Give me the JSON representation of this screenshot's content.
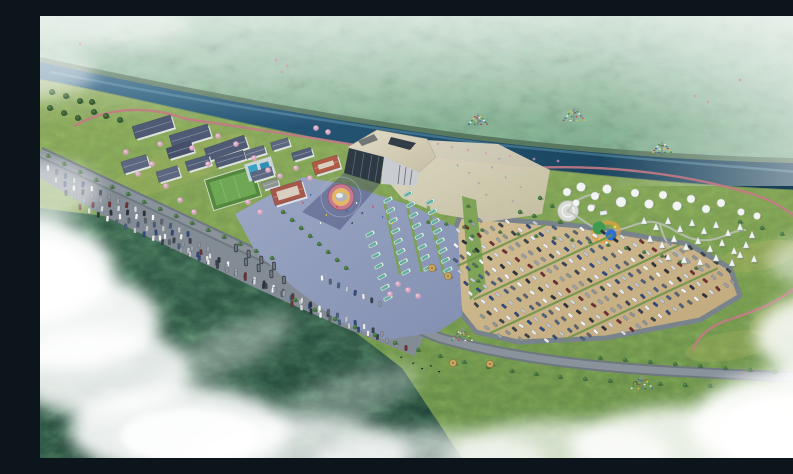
{
  "meta": {
    "title": "Aerial rendering of riverside visitor-center resort",
    "description": "Bird's-eye architectural rendering: forested mountain across a river, visitor center with faceted roof on a blue plaza, residential blocks, bus and dirt car parking lots full of vehicles, glamping dome and teepee camp, red walking trail, clouds and mist at the edges.",
    "width": 793,
    "height": 442
  },
  "palette": {
    "mountain_green": "#74a183",
    "haze_white": "#ffffff",
    "river_blue": "#1f4a66",
    "river_light": "#5e93ad",
    "grass_green": "#7a9c52",
    "grass_yellow": "#b7b565",
    "forest_dark": "#2c5644",
    "plaza_blue": "#96a2bf",
    "dirt_tan": "#c9b289",
    "gravel_tan": "#d8cfb4",
    "road_grey": "#79838b",
    "roof_beige": "#d5cfba",
    "glass_dark": "#2e3944",
    "roof_slate": "#4f5a74",
    "roof_red": "#a8584a",
    "trail_red": "#c2607a",
    "bus_teal": "#5fae9e",
    "field_green": "#5f9447",
    "pool_blue": "#39a3c6",
    "blossom_pink": "#d9a3c0",
    "tent_white": "#f2f4f4"
  },
  "scene": {
    "car_colors": [
      "#f2f4f6",
      "#e8eaec",
      "#d7dadd",
      "#c2c7cc",
      "#9aa1a8",
      "#5b646e",
      "#3a424c",
      "#2c333c",
      "#31497e",
      "#6e2f35",
      "#49607f",
      "#8d939a"
    ],
    "flag_colors": [
      "#c23b3b",
      "#e8c63f",
      "#2f8a4c",
      "#f2f2f2",
      "#2f5fae"
    ],
    "main_lot": {
      "polygon": [
        [
          420,
          200
        ],
        [
          540,
          210
        ],
        [
          648,
          228
        ],
        [
          690,
          252
        ],
        [
          700,
          280
        ],
        [
          660,
          304
        ],
        [
          566,
          322
        ],
        [
          478,
          326
        ],
        [
          436,
          316
        ],
        [
          420,
          296
        ],
        [
          414,
          250
        ],
        [
          414,
          216
        ]
      ],
      "origin": [
        404,
        222
      ],
      "u": [
        7.3,
        -3.4
      ],
      "v": [
        5.4,
        11.2
      ],
      "ni": 46,
      "nj": 14,
      "hedge_rows": [
        2,
        5,
        8,
        11
      ],
      "car_angle": 41
    },
    "car_rows": [
      {
        "s": [
          8,
          152
        ],
        "e": [
          148,
          218
        ],
        "n": 17
      },
      {
        "s": [
          16,
          164
        ],
        "e": [
          168,
          233
        ],
        "n": 18
      },
      {
        "s": [
          26,
          177
        ],
        "e": [
          188,
          248
        ],
        "n": 19
      },
      {
        "s": [
          40,
          191
        ],
        "e": [
          214,
          265
        ],
        "n": 20
      },
      {
        "s": [
          120,
          222
        ],
        "e": [
          262,
          284
        ],
        "n": 16
      },
      {
        "s": [
          150,
          238
        ],
        "e": [
          288,
          298
        ],
        "n": 16
      },
      {
        "s": [
          226,
          270
        ],
        "e": [
          342,
          318
        ],
        "n": 14
      },
      {
        "s": [
          252,
          288
        ],
        "e": [
          366,
          332
        ],
        "n": 13
      },
      {
        "s": [
          282,
          262
        ],
        "e": [
          340,
          288
        ],
        "n": 8
      }
    ],
    "bus_rows": [
      {
        "s": [
          348,
          184
        ],
        "e": [
          366,
          256
        ],
        "n": 8
      },
      {
        "s": [
          368,
          178
        ],
        "e": [
          388,
          252
        ],
        "n": 8
      },
      {
        "s": [
          390,
          186
        ],
        "e": [
          408,
          254
        ],
        "n": 8
      },
      {
        "s": [
          330,
          218
        ],
        "e": [
          348,
          282
        ],
        "n": 7
      }
    ],
    "shuttle_rows": [
      {
        "s": [
          196,
          232
        ],
        "e": [
          234,
          250
        ],
        "n": 4
      },
      {
        "s": [
          206,
          246
        ],
        "e": [
          244,
          264
        ],
        "n": 4
      }
    ],
    "buildings": [
      {
        "c": [
          113,
          111
        ],
        "w": 40,
        "h": 13,
        "r": -17,
        "roof": "#4f5a74"
      },
      {
        "c": [
          150,
          120
        ],
        "w": 40,
        "h": 13,
        "r": -17,
        "roof": "#4f5a74"
      },
      {
        "c": [
          186,
          132
        ],
        "w": 42,
        "h": 13,
        "r": -19,
        "roof": "#4f5a74"
      },
      {
        "c": [
          140,
          134
        ],
        "w": 26,
        "h": 11,
        "r": -17,
        "roof": "#46506a"
      },
      {
        "c": [
          95,
          148
        ],
        "w": 26,
        "h": 12,
        "r": -17,
        "roof": "#5d6880"
      },
      {
        "c": [
          128,
          158
        ],
        "w": 22,
        "h": 11,
        "r": -17,
        "roof": "#5d6880"
      },
      {
        "c": [
          158,
          147
        ],
        "w": 24,
        "h": 10,
        "r": -17,
        "roof": "#525e78"
      },
      {
        "c": [
          190,
          143
        ],
        "w": 30,
        "h": 9,
        "r": -17,
        "roof": "#4f5a74"
      },
      {
        "c": [
          215,
          136
        ],
        "w": 20,
        "h": 8,
        "r": -17,
        "roof": "#5d6880"
      },
      {
        "c": [
          240,
          128
        ],
        "w": 18,
        "h": 8,
        "r": -17,
        "roof": "#5d6880"
      },
      {
        "c": [
          262,
          138
        ],
        "w": 20,
        "h": 8,
        "r": -17,
        "roof": "#525e78"
      },
      {
        "c": [
          222,
          158
        ],
        "w": 22,
        "h": 9,
        "r": -17,
        "roof": "#5d6880"
      },
      {
        "c": [
          230,
          168
        ],
        "w": 16,
        "h": 7,
        "r": -17,
        "roof": "#8d968f"
      },
      {
        "c": [
          286,
          149
        ],
        "w": 26,
        "h": 13,
        "r": -17,
        "roof": "#b05a44",
        "court": true
      },
      {
        "c": [
          248,
          177
        ],
        "w": 32,
        "h": 17,
        "r": -17,
        "roof": "#a8584a",
        "court": true
      }
    ],
    "trees": [
      [
        255,
        284
      ],
      [
        275,
        294
      ],
      [
        295,
        303
      ],
      [
        315,
        311
      ],
      [
        335,
        319
      ],
      [
        355,
        327
      ],
      [
        378,
        334
      ],
      [
        400,
        340
      ],
      [
        424,
        346
      ],
      [
        448,
        351
      ],
      [
        472,
        355
      ],
      [
        496,
        358
      ],
      [
        520,
        361
      ],
      [
        545,
        363
      ],
      [
        570,
        365
      ],
      [
        595,
        367
      ],
      [
        620,
        368
      ],
      [
        645,
        369
      ],
      [
        670,
        370
      ],
      [
        560,
        342
      ],
      [
        585,
        344
      ],
      [
        610,
        346
      ],
      [
        635,
        348
      ],
      [
        660,
        350
      ],
      [
        685,
        352
      ],
      [
        710,
        354
      ],
      [
        735,
        356
      ],
      [
        760,
        358
      ],
      [
        243,
        196
      ],
      [
        252,
        204
      ],
      [
        261,
        212
      ],
      [
        270,
        220
      ],
      [
        279,
        228
      ],
      [
        288,
        236
      ],
      [
        297,
        244
      ],
      [
        306,
        252
      ],
      [
        8,
        140
      ],
      [
        24,
        148
      ],
      [
        40,
        156
      ],
      [
        56,
        164
      ],
      [
        72,
        171
      ],
      [
        88,
        178
      ],
      [
        104,
        186
      ],
      [
        120,
        193
      ],
      [
        136,
        200
      ],
      [
        152,
        207
      ],
      [
        168,
        214
      ],
      [
        184,
        221
      ],
      [
        200,
        228
      ],
      [
        216,
        235
      ],
      [
        232,
        242
      ],
      [
        428,
        190,
        1.8
      ],
      [
        430,
        205,
        1.8
      ],
      [
        432,
        220,
        1.8
      ],
      [
        434,
        235,
        1.8
      ],
      [
        436,
        250,
        1.8
      ],
      [
        438,
        265,
        1.8
      ],
      [
        388,
        206,
        1.8
      ],
      [
        406,
        208,
        1.8
      ],
      [
        424,
        211,
        1.8
      ],
      [
        442,
        214,
        1.8
      ],
      [
        460,
        216,
        1.8
      ],
      [
        478,
        218,
        1.8
      ],
      [
        496,
        220,
        1.8
      ],
      [
        514,
        222,
        1.8
      ],
      [
        532,
        224,
        1.8
      ],
      [
        550,
        226,
        1.8
      ],
      [
        568,
        229,
        1.8
      ],
      [
        586,
        232,
        1.8
      ],
      [
        604,
        236,
        1.8
      ],
      [
        622,
        240,
        1.8
      ],
      [
        640,
        246,
        1.8
      ],
      [
        656,
        252,
        1.8
      ],
      [
        500,
        182
      ],
      [
        512,
        190
      ],
      [
        494,
        200
      ],
      [
        520,
        206
      ],
      [
        480,
        196
      ],
      [
        700,
        206
      ],
      [
        722,
        212
      ],
      [
        742,
        218
      ]
    ],
    "bushes": [
      [
        12,
        76
      ],
      [
        26,
        80
      ],
      [
        40,
        85
      ],
      [
        10,
        92
      ],
      [
        24,
        97
      ],
      [
        38,
        102
      ],
      [
        54,
        96
      ],
      [
        66,
        100
      ],
      [
        80,
        104
      ],
      [
        52,
        86
      ]
    ],
    "blossoms": [
      [
        86,
        136
      ],
      [
        98,
        158
      ],
      [
        112,
        148
      ],
      [
        126,
        170
      ],
      [
        140,
        184
      ],
      [
        154,
        196
      ],
      [
        168,
        148
      ],
      [
        178,
        120
      ],
      [
        196,
        128
      ],
      [
        214,
        142
      ],
      [
        228,
        154
      ],
      [
        120,
        128
      ],
      [
        152,
        132
      ],
      [
        256,
        152
      ],
      [
        270,
        162
      ],
      [
        208,
        186
      ],
      [
        220,
        196
      ],
      [
        240,
        160
      ],
      [
        358,
        268
      ],
      [
        368,
        274
      ],
      [
        378,
        280
      ],
      [
        350,
        278
      ],
      [
        276,
        112
      ],
      [
        288,
        116
      ]
    ],
    "bank_pink": [
      [
        398,
        128
      ],
      [
        412,
        131
      ],
      [
        428,
        134
      ],
      [
        446,
        137
      ],
      [
        470,
        140
      ],
      [
        494,
        143
      ],
      [
        518,
        145
      ],
      [
        236,
        44
      ],
      [
        247,
        50
      ],
      [
        242,
        56
      ],
      [
        655,
        80
      ],
      [
        668,
        86
      ],
      [
        40,
        28
      ],
      [
        700,
        64
      ]
    ],
    "domes": [
      [
        527,
        176,
        4
      ],
      [
        541,
        171,
        4.5
      ],
      [
        555,
        180,
        4
      ],
      [
        567,
        173,
        4.5
      ],
      [
        581,
        186,
        5
      ],
      [
        595,
        177,
        4
      ],
      [
        609,
        188,
        4.5
      ],
      [
        623,
        179,
        4
      ],
      [
        637,
        190,
        4.5
      ],
      [
        651,
        183,
        4
      ],
      [
        666,
        193,
        4
      ],
      [
        681,
        187,
        4
      ],
      [
        701,
        196,
        3.5
      ],
      [
        717,
        200,
        3.5
      ],
      [
        536,
        187,
        3.5
      ],
      [
        551,
        192,
        3.5
      ]
    ],
    "teepees": [
      [
        604,
        206
      ],
      [
        616,
        212
      ],
      [
        628,
        206
      ],
      [
        640,
        214
      ],
      [
        652,
        208
      ],
      [
        664,
        216
      ],
      [
        676,
        210
      ],
      [
        688,
        218
      ],
      [
        700,
        212
      ],
      [
        712,
        220
      ],
      [
        610,
        224
      ],
      [
        622,
        230
      ],
      [
        634,
        224
      ],
      [
        646,
        232
      ],
      [
        658,
        226
      ],
      [
        670,
        234
      ],
      [
        682,
        228
      ],
      [
        694,
        236
      ],
      [
        706,
        230
      ],
      [
        628,
        242
      ],
      [
        644,
        245
      ],
      [
        660,
        247
      ],
      [
        676,
        243
      ],
      [
        692,
        248
      ],
      [
        700,
        240
      ],
      [
        714,
        244
      ]
    ],
    "towers": [
      [
        438,
        108,
        1
      ],
      [
        534,
        104,
        1.15
      ],
      [
        622,
        136,
        1
      ],
      [
        422,
        324,
        1.1
      ],
      [
        602,
        372,
        1.15
      ]
    ],
    "huts": [
      [
        413,
        347
      ],
      [
        450,
        348
      ],
      [
        408,
        260
      ],
      [
        392,
        252
      ]
    ],
    "yaks": [
      [
        372,
        347
      ],
      [
        381,
        352
      ],
      [
        390,
        349
      ],
      [
        360,
        341
      ],
      [
        398,
        355
      ]
    ],
    "people": [
      [
        296,
        190
      ],
      [
        306,
        194
      ],
      [
        316,
        186
      ],
      [
        286,
        198
      ],
      [
        322,
        196
      ],
      [
        332,
        190
      ],
      [
        342,
        200
      ],
      [
        280,
        206
      ],
      [
        352,
        206
      ],
      [
        312,
        206
      ],
      [
        262,
        186
      ],
      [
        270,
        178
      ]
    ],
    "gravel_marks": [
      [
        428,
        156
      ],
      [
        438,
        166
      ],
      [
        452,
        150
      ],
      [
        466,
        160
      ],
      [
        445,
        178
      ],
      [
        480,
        170
      ],
      [
        430,
        186
      ],
      [
        418,
        148
      ],
      [
        458,
        142
      ],
      [
        472,
        184
      ]
    ],
    "counts": {
      "residential_buildings": 15,
      "bus_rows": 4,
      "roadside_car_rows": 9,
      "dome_tents": 16,
      "teepee_tents": 26,
      "prayer_flag_towers": 5
    }
  }
}
